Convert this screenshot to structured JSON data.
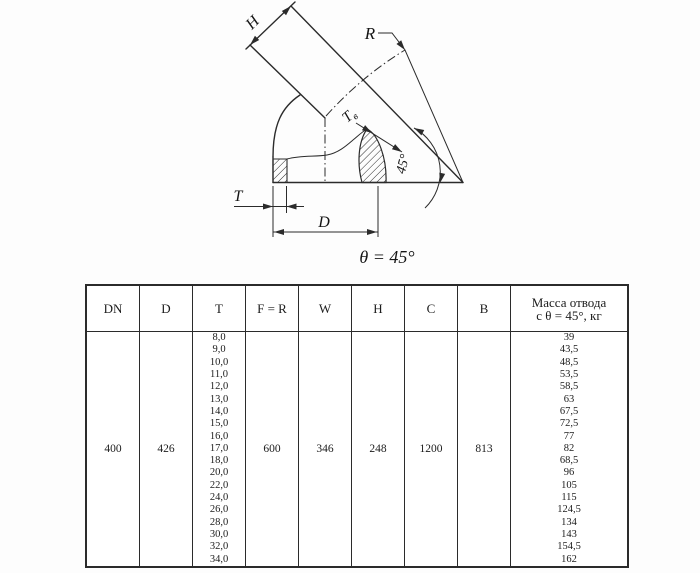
{
  "drawing": {
    "labels": {
      "h": "H",
      "r": "R",
      "tb_t": "T",
      "tb_sub": "в",
      "angle": "45°",
      "t": "T",
      "d": "D"
    },
    "caption": "θ = 45°"
  },
  "table": {
    "headers": [
      "DN",
      "D",
      "T",
      "F = R",
      "W",
      "H",
      "C",
      "B"
    ],
    "mass_header": [
      "Масса отвода",
      "с θ = 45°, кг"
    ],
    "row": {
      "dn": "400",
      "d": "426",
      "f_r": "600",
      "w": "346",
      "h": "248",
      "c": "1200",
      "b": "813"
    },
    "t_values": [
      "8,0",
      "9,0",
      "10,0",
      "11,0",
      "12,0",
      "13,0",
      "14,0",
      "15,0",
      "16,0",
      "17,0",
      "18,0",
      "20,0",
      "22,0",
      "24,0",
      "26,0",
      "28,0",
      "30,0",
      "32,0",
      "34,0"
    ],
    "mass_values": [
      "39",
      "43,5",
      "48,5",
      "53,5",
      "58,5",
      "63",
      "67,5",
      "72,5",
      "77",
      "82",
      "68,5",
      "96",
      "105",
      "115",
      "124,5",
      "134",
      "143",
      "154,5",
      "162"
    ]
  },
  "colors": {
    "line": "#2b2b2b",
    "background": "#ffffff"
  }
}
